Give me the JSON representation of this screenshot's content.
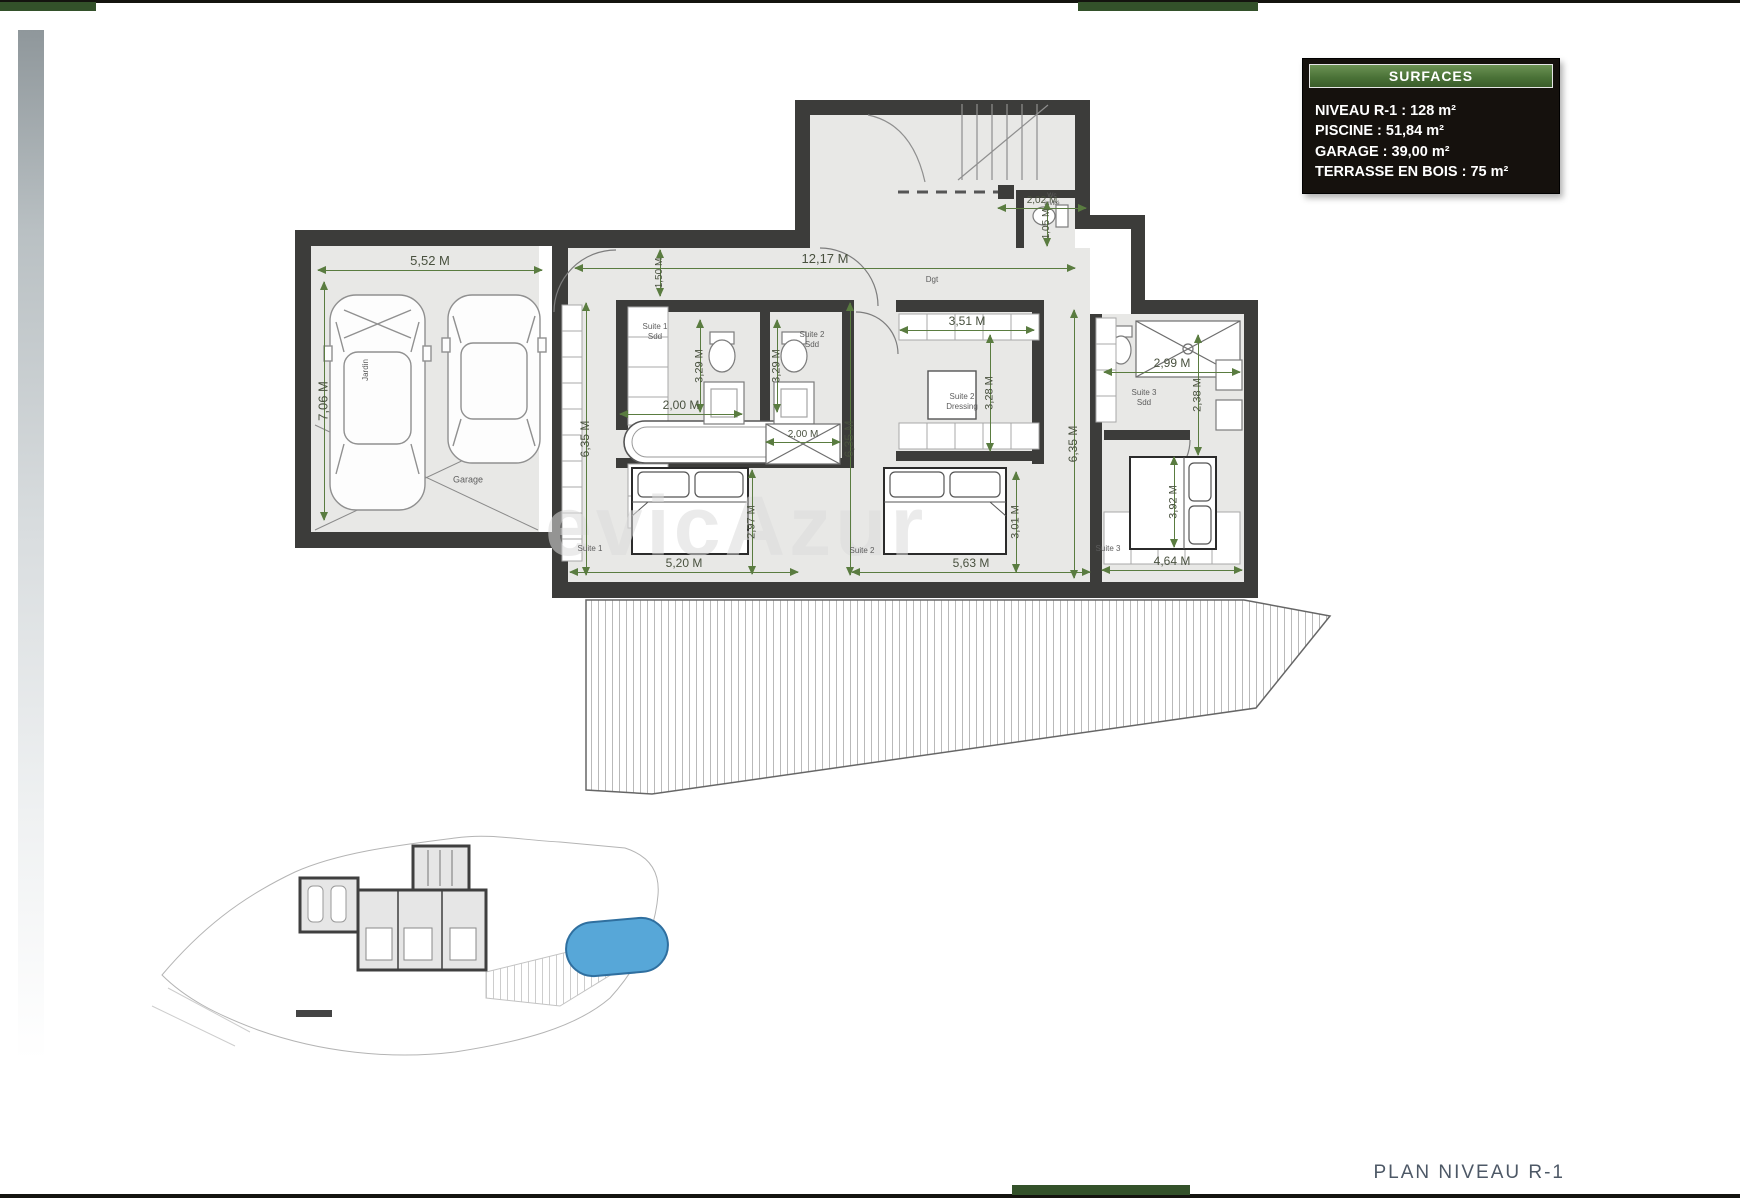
{
  "surfaces": {
    "title": "SURFACES",
    "items": [
      {
        "text": "NIVEAU R-1 : 128 m²"
      },
      {
        "text": "PISCINE : 51,84 m²"
      },
      {
        "text": "GARAGE : 39,00 m²"
      },
      {
        "text": "TERRASSE EN BOIS : 75 m²"
      }
    ]
  },
  "footer": {
    "title": "PLAN NIVEAU R-1"
  },
  "watermark": {
    "text": "evicAzur"
  },
  "colors": {
    "accent_green": "#33512a",
    "panel_header_green": "#4b7338",
    "panel_bg": "#15110d",
    "wall": "#3c3c3a",
    "floor": "#e8e8e6",
    "dimension_green": "#5a7c40",
    "pool_blue": "#57a7d8"
  },
  "plan": {
    "unit": "M",
    "dimensions": [
      {
        "text": "5,52 M",
        "dir": "h",
        "x": 318,
        "y": 270,
        "len": 224
      },
      {
        "text": "7,06 M",
        "dir": "v",
        "x": 324,
        "y": 282,
        "len": 238
      },
      {
        "text": "12,17 M",
        "dir": "h",
        "x": 575,
        "y": 268,
        "len": 500
      },
      {
        "text": "1,50 M",
        "dir": "v",
        "x": 660,
        "y": 250,
        "len": 46,
        "fs": 10
      },
      {
        "text": "2,02 M",
        "dir": "h",
        "x": 998,
        "y": 208,
        "len": 88,
        "fs": 10
      },
      {
        "text": "1,05 M",
        "dir": "v",
        "x": 1047,
        "y": 202,
        "len": 44,
        "fs": 10
      },
      {
        "text": "3,29 M",
        "dir": "v",
        "x": 700,
        "y": 320,
        "len": 92,
        "fs": 11
      },
      {
        "text": "3,29 M",
        "dir": "v",
        "x": 777,
        "y": 320,
        "len": 92,
        "fs": 11
      },
      {
        "text": "2,00 M",
        "dir": "h",
        "x": 620,
        "y": 414,
        "len": 122,
        "fs": 12
      },
      {
        "text": "2,00 M",
        "dir": "h",
        "x": 766,
        "y": 442,
        "len": 74,
        "fs": 10
      },
      {
        "text": "3,51 M",
        "dir": "h",
        "x": 900,
        "y": 330,
        "len": 134,
        "fs": 12
      },
      {
        "text": "3,28 M",
        "dir": "v",
        "x": 990,
        "y": 335,
        "len": 116,
        "fs": 11
      },
      {
        "text": "2,99 M",
        "dir": "h",
        "x": 1104,
        "y": 372,
        "len": 136,
        "fs": 12
      },
      {
        "text": "2,38 M",
        "dir": "v",
        "x": 1198,
        "y": 335,
        "len": 120,
        "fs": 11
      },
      {
        "text": "6,35 M",
        "dir": "v",
        "x": 586,
        "y": 303,
        "len": 272,
        "fs": 12
      },
      {
        "text": "6,35 M",
        "dir": "v",
        "x": 850,
        "y": 303,
        "len": 272,
        "fs": 12
      },
      {
        "text": "6,35 M",
        "dir": "v",
        "x": 1074,
        "y": 310,
        "len": 268,
        "fs": 12
      },
      {
        "text": "5,20 M",
        "dir": "h",
        "x": 570,
        "y": 572,
        "len": 228,
        "fs": 12
      },
      {
        "text": "2,97 M",
        "dir": "v",
        "x": 752,
        "y": 470,
        "len": 104,
        "fs": 11
      },
      {
        "text": "5,63 M",
        "dir": "h",
        "x": 852,
        "y": 572,
        "len": 238,
        "fs": 12
      },
      {
        "text": "3,01 M",
        "dir": "v",
        "x": 1016,
        "y": 472,
        "len": 100,
        "fs": 11
      },
      {
        "text": "4,64 M",
        "dir": "h",
        "x": 1102,
        "y": 570,
        "len": 140,
        "fs": 12
      },
      {
        "text": "3,92 M",
        "dir": "v",
        "x": 1174,
        "y": 457,
        "len": 90,
        "fs": 11
      }
    ],
    "room_labels": [
      {
        "text": "Suite 1\nSdd",
        "x": 655,
        "y": 332
      },
      {
        "text": "Suite 2\nSdd",
        "x": 812,
        "y": 340
      },
      {
        "text": "Suite 2\nDressing",
        "x": 962,
        "y": 402
      },
      {
        "text": "Suite 3\nSdd",
        "x": 1144,
        "y": 398
      },
      {
        "text": "Wc\ninvité",
        "x": 1052,
        "y": 200,
        "fs": 6.5
      },
      {
        "text": "Dgt",
        "x": 932,
        "y": 280
      },
      {
        "text": "Suite 1",
        "x": 590,
        "y": 549
      },
      {
        "text": "Suite 2",
        "x": 862,
        "y": 551
      },
      {
        "text": "Suite 3",
        "x": 1108,
        "y": 549
      },
      {
        "text": "Garage",
        "x": 468,
        "y": 480,
        "fs": 9
      },
      {
        "text": "Jardin",
        "x": 366,
        "y": 370,
        "rot": true,
        "fs": 8
      }
    ]
  }
}
